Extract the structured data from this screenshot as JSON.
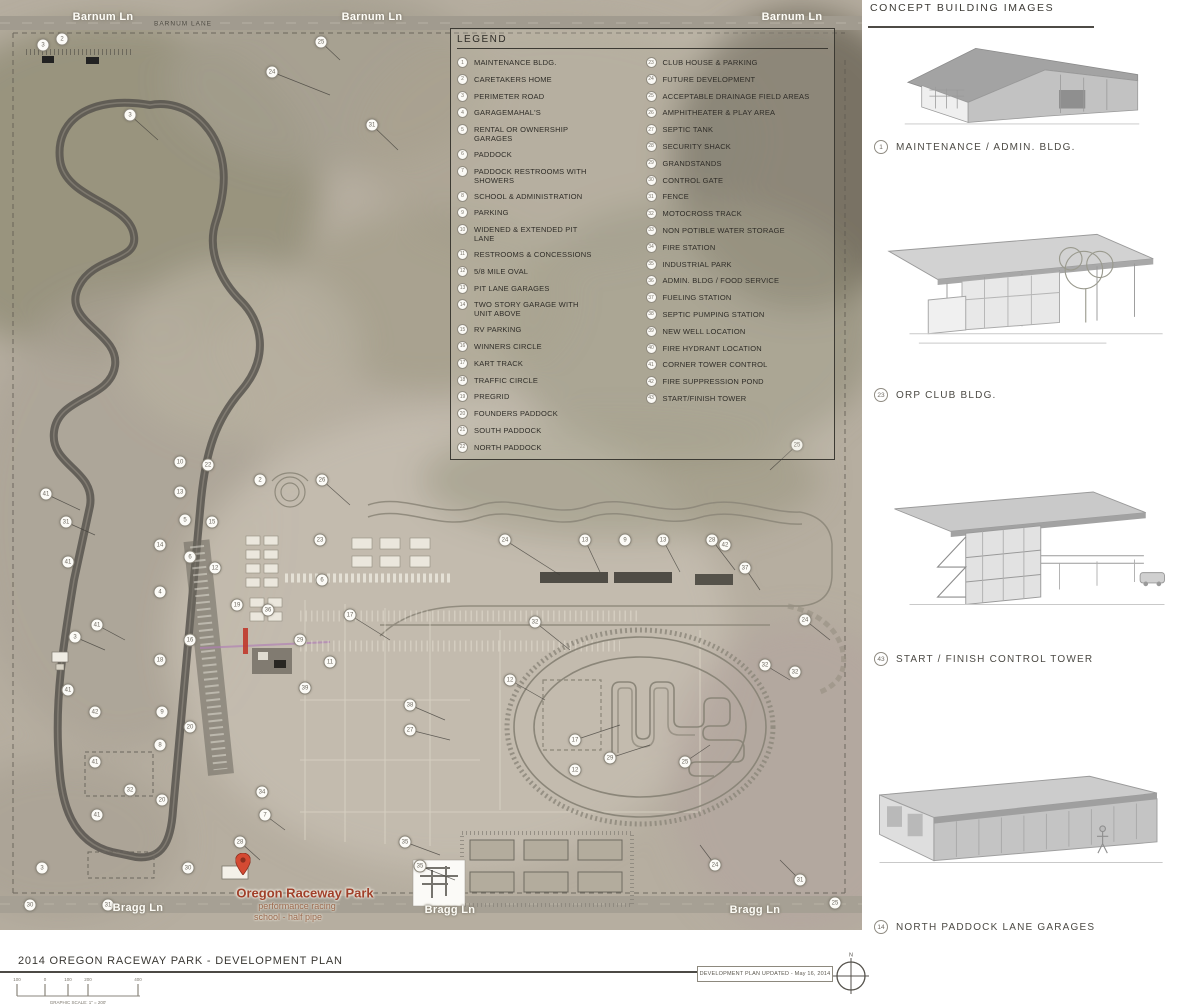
{
  "legend": {
    "title": "LEGEND",
    "items_left": [
      {
        "n": 1,
        "label": "MAINTENANCE BLDG."
      },
      {
        "n": 2,
        "label": "CARETAKERS HOME"
      },
      {
        "n": 3,
        "label": "PERIMETER ROAD"
      },
      {
        "n": 4,
        "label": "GARAGEMAHAL'S"
      },
      {
        "n": 5,
        "label": "RENTAL OR OWNERSHIP GARAGES"
      },
      {
        "n": 6,
        "label": "PADDOCK"
      },
      {
        "n": 7,
        "label": "PADDOCK RESTROOMS WITH SHOWERS"
      },
      {
        "n": 8,
        "label": "SCHOOL & ADMINISTRATION"
      },
      {
        "n": 9,
        "label": "PARKING"
      },
      {
        "n": 10,
        "label": "WIDENED & EXTENDED PIT LANE"
      },
      {
        "n": 11,
        "label": "RESTROOMS & CONCESSIONS"
      },
      {
        "n": 12,
        "label": "5/8 MILE OVAL"
      },
      {
        "n": 13,
        "label": "PIT LANE GARAGES"
      },
      {
        "n": 14,
        "label": "TWO STORY GARAGE WITH UNIT ABOVE"
      },
      {
        "n": 15,
        "label": "RV PARKING"
      },
      {
        "n": 16,
        "label": "WINNERS CIRCLE"
      },
      {
        "n": 17,
        "label": "KART TRACK"
      },
      {
        "n": 18,
        "label": "TRAFFIC CIRCLE"
      },
      {
        "n": 19,
        "label": "PREGRID"
      },
      {
        "n": 20,
        "label": "FOUNDERS PADDOCK"
      },
      {
        "n": 21,
        "label": "SOUTH PADDOCK"
      },
      {
        "n": 22,
        "label": "NORTH PADDOCK"
      }
    ],
    "items_right": [
      {
        "n": 23,
        "label": "CLUB HOUSE & PARKING"
      },
      {
        "n": 24,
        "label": "FUTURE DEVELOPMENT"
      },
      {
        "n": 25,
        "label": "ACCEPTABLE DRAINAGE FIELD AREAS"
      },
      {
        "n": 26,
        "label": "AMPHITHEATER & PLAY AREA"
      },
      {
        "n": 27,
        "label": "SEPTIC TANK"
      },
      {
        "n": 28,
        "label": "SECURITY SHACK"
      },
      {
        "n": 29,
        "label": "GRANDSTANDS"
      },
      {
        "n": 30,
        "label": "CONTROL GATE"
      },
      {
        "n": 31,
        "label": "FENCE"
      },
      {
        "n": 32,
        "label": "MOTOCROSS TRACK"
      },
      {
        "n": 33,
        "label": "NON POTIBLE WATER STORAGE"
      },
      {
        "n": 34,
        "label": "FIRE STATION"
      },
      {
        "n": 35,
        "label": "INDUSTRIAL PARK"
      },
      {
        "n": 36,
        "label": "ADMIN. BLDG / FOOD SERVICE"
      },
      {
        "n": 37,
        "label": "FUELING STATION"
      },
      {
        "n": 38,
        "label": "SEPTIC PUMPING STATION"
      },
      {
        "n": 39,
        "label": "NEW WELL LOCATION"
      },
      {
        "n": 40,
        "label": "FIRE HYDRANT LOCATION"
      },
      {
        "n": 41,
        "label": "CORNER TOWER CONTROL"
      },
      {
        "n": 42,
        "label": "FIRE SUPPRESSION POND"
      },
      {
        "n": 43,
        "label": "START/FINISH TOWER"
      }
    ]
  },
  "map": {
    "road_labels": {
      "barnum_left": "Barnum Ln",
      "barnum_small": "BARNUM LANE",
      "barnum_mid": "Barnum Ln",
      "barnum_right": "Barnum Ln",
      "bragg_left": "Bragg Ln",
      "bragg_center": "Bragg Ln",
      "bragg_right": "Bragg Ln"
    },
    "poi": {
      "title": "Oregon Raceway Park",
      "subtitle1": "performance racing",
      "subtitle2": "school - half pipe"
    },
    "markers": [
      {
        "n": 2,
        "x": 62,
        "y": 39
      },
      {
        "n": 3,
        "x": 43,
        "y": 45
      },
      {
        "n": 25,
        "x": 321,
        "y": 42
      },
      {
        "n": 24,
        "x": 272,
        "y": 72
      },
      {
        "n": 3,
        "x": 130,
        "y": 115
      },
      {
        "n": 31,
        "x": 372,
        "y": 125
      },
      {
        "n": 25,
        "x": 797,
        "y": 445
      },
      {
        "n": 10,
        "x": 180,
        "y": 462
      },
      {
        "n": 22,
        "x": 208,
        "y": 465
      },
      {
        "n": 26,
        "x": 322,
        "y": 480
      },
      {
        "n": 2,
        "x": 260,
        "y": 480
      },
      {
        "n": 41,
        "x": 46,
        "y": 494
      },
      {
        "n": 13,
        "x": 180,
        "y": 492
      },
      {
        "n": 5,
        "x": 185,
        "y": 520
      },
      {
        "n": 15,
        "x": 212,
        "y": 522
      },
      {
        "n": 31,
        "x": 66,
        "y": 522
      },
      {
        "n": 23,
        "x": 320,
        "y": 540
      },
      {
        "n": 14,
        "x": 160,
        "y": 545
      },
      {
        "n": 6,
        "x": 190,
        "y": 557
      },
      {
        "n": 41,
        "x": 68,
        "y": 562
      },
      {
        "n": 12,
        "x": 215,
        "y": 568
      },
      {
        "n": 6,
        "x": 322,
        "y": 580
      },
      {
        "n": 4,
        "x": 160,
        "y": 592
      },
      {
        "n": 19,
        "x": 237,
        "y": 605
      },
      {
        "n": 36,
        "x": 268,
        "y": 610
      },
      {
        "n": 17,
        "x": 350,
        "y": 615
      },
      {
        "n": 41,
        "x": 97,
        "y": 625
      },
      {
        "n": 3,
        "x": 75,
        "y": 637
      },
      {
        "n": 16,
        "x": 190,
        "y": 640
      },
      {
        "n": 29,
        "x": 300,
        "y": 640
      },
      {
        "n": 18,
        "x": 160,
        "y": 660
      },
      {
        "n": 11,
        "x": 330,
        "y": 662
      },
      {
        "n": 41,
        "x": 68,
        "y": 690
      },
      {
        "n": 39,
        "x": 305,
        "y": 688
      },
      {
        "n": 42,
        "x": 95,
        "y": 712
      },
      {
        "n": 9,
        "x": 162,
        "y": 712
      },
      {
        "n": 20,
        "x": 190,
        "y": 727
      },
      {
        "n": 38,
        "x": 410,
        "y": 705
      },
      {
        "n": 27,
        "x": 410,
        "y": 730
      },
      {
        "n": 8,
        "x": 160,
        "y": 745
      },
      {
        "n": 41,
        "x": 95,
        "y": 762
      },
      {
        "n": 17,
        "x": 575,
        "y": 740
      },
      {
        "n": 12,
        "x": 575,
        "y": 770
      },
      {
        "n": 32,
        "x": 130,
        "y": 790
      },
      {
        "n": 20,
        "x": 162,
        "y": 800
      },
      {
        "n": 34,
        "x": 262,
        "y": 792
      },
      {
        "n": 41,
        "x": 97,
        "y": 815
      },
      {
        "n": 7,
        "x": 265,
        "y": 815
      },
      {
        "n": 28,
        "x": 240,
        "y": 842
      },
      {
        "n": 30,
        "x": 188,
        "y": 868
      },
      {
        "n": 3,
        "x": 42,
        "y": 868
      },
      {
        "n": 30,
        "x": 30,
        "y": 905
      },
      {
        "n": 31,
        "x": 108,
        "y": 905
      },
      {
        "n": 24,
        "x": 505,
        "y": 540
      },
      {
        "n": 13,
        "x": 585,
        "y": 540
      },
      {
        "n": 9,
        "x": 625,
        "y": 540
      },
      {
        "n": 13,
        "x": 663,
        "y": 540
      },
      {
        "n": 28,
        "x": 712,
        "y": 540
      },
      {
        "n": 37,
        "x": 745,
        "y": 568
      },
      {
        "n": 42,
        "x": 725,
        "y": 545
      },
      {
        "n": 12,
        "x": 510,
        "y": 680
      },
      {
        "n": 32,
        "x": 535,
        "y": 622
      },
      {
        "n": 25,
        "x": 685,
        "y": 762
      },
      {
        "n": 29,
        "x": 610,
        "y": 758
      },
      {
        "n": 32,
        "x": 765,
        "y": 665
      },
      {
        "n": 24,
        "x": 805,
        "y": 620
      },
      {
        "n": 32,
        "x": 795,
        "y": 672
      },
      {
        "n": 35,
        "x": 405,
        "y": 842
      },
      {
        "n": 35,
        "x": 420,
        "y": 866
      },
      {
        "n": 24,
        "x": 715,
        "y": 865
      },
      {
        "n": 31,
        "x": 800,
        "y": 880
      },
      {
        "n": 25,
        "x": 835,
        "y": 903
      }
    ]
  },
  "sidebar": {
    "title": "CONCEPT BUILDING IMAGES",
    "figures": [
      {
        "n": "1",
        "label": "MAINTENANCE / ADMIN. BLDG."
      },
      {
        "n": "23",
        "label": "ORP CLUB BLDG."
      },
      {
        "n": "43",
        "label": "START / FINISH CONTROL TOWER"
      },
      {
        "n": "14",
        "label": "NORTH PADDOCK LANE GARAGES"
      }
    ]
  },
  "footer": {
    "title": "2014 OREGON RACEWAY PARK - DEVELOPMENT PLAN",
    "updated": "DEVELOPMENT PLAN UPDATED - May 16, 2014",
    "compass_n": "N",
    "scale_label": "GRAPHIC SCALE: 1\" = 200'",
    "scale_ticks": [
      "100",
      "0",
      "100",
      "200",
      "400"
    ]
  },
  "colors": {
    "terrain_base": "#b6aea0",
    "track_stroke": "#57544d",
    "pin_red": "#d44a33",
    "line_dark": "#4c4a45"
  }
}
